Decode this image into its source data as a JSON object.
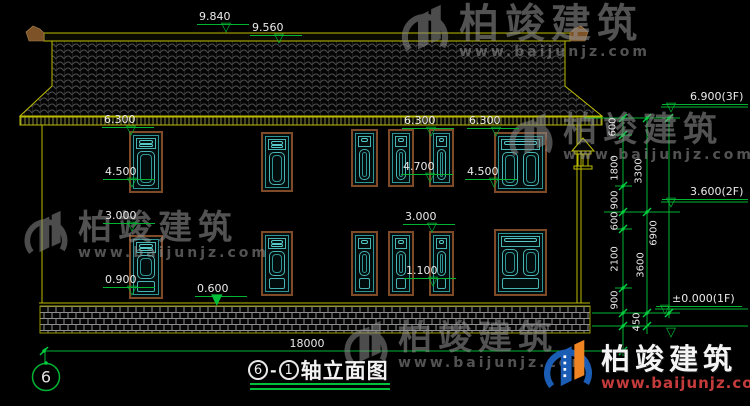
{
  "drawing_title": {
    "axis_from": "6",
    "separator": "-",
    "axis_to": "1",
    "label": "轴立面图"
  },
  "axis_bubble": {
    "label": "6"
  },
  "elevation_marks": [
    {
      "value": "9.840"
    },
    {
      "value": "9.560"
    },
    {
      "value": "6.300"
    },
    {
      "value": "4.500"
    },
    {
      "value": "3.000"
    },
    {
      "value": "0.900"
    },
    {
      "value": "0.600"
    },
    {
      "value": "6.300"
    },
    {
      "value": "6.300"
    },
    {
      "value": "4.700"
    },
    {
      "value": "4.500"
    },
    {
      "value": "3.000"
    },
    {
      "value": "1.100"
    },
    {
      "value": "6.900(3F)"
    },
    {
      "value": "3.600(2F)"
    },
    {
      "value": "±0.000(1F)"
    }
  ],
  "vertical_dims": [
    {
      "value": "600"
    },
    {
      "value": "1800"
    },
    {
      "value": "900"
    },
    {
      "value": "600"
    },
    {
      "value": "2100"
    },
    {
      "value": "900"
    },
    {
      "value": "450"
    },
    {
      "value": "3300"
    },
    {
      "value": "3600"
    },
    {
      "value": "6900"
    }
  ],
  "horizontal_dims": [
    {
      "value": "18000"
    }
  ],
  "watermark": {
    "brand": "柏竣建筑",
    "url": "www.baijunjz.com"
  },
  "logo": {
    "brand": "柏竣建筑",
    "url": "www.baijunjz.com"
  },
  "symbols": {
    "tri_open": "▽",
    "tri_filled": "▼"
  },
  "colors": {
    "background": "#000000",
    "linework_yellow": "#bdbd00",
    "dimension_green": "#00b432",
    "window_teal": "#49b4b4",
    "window_frame_brown": "#7e4a28",
    "text_white": "#eaeaea",
    "logo_blue": "#1b5cb4",
    "logo_orange": "#ee8422",
    "logo_url_red": "#c43b3b"
  }
}
